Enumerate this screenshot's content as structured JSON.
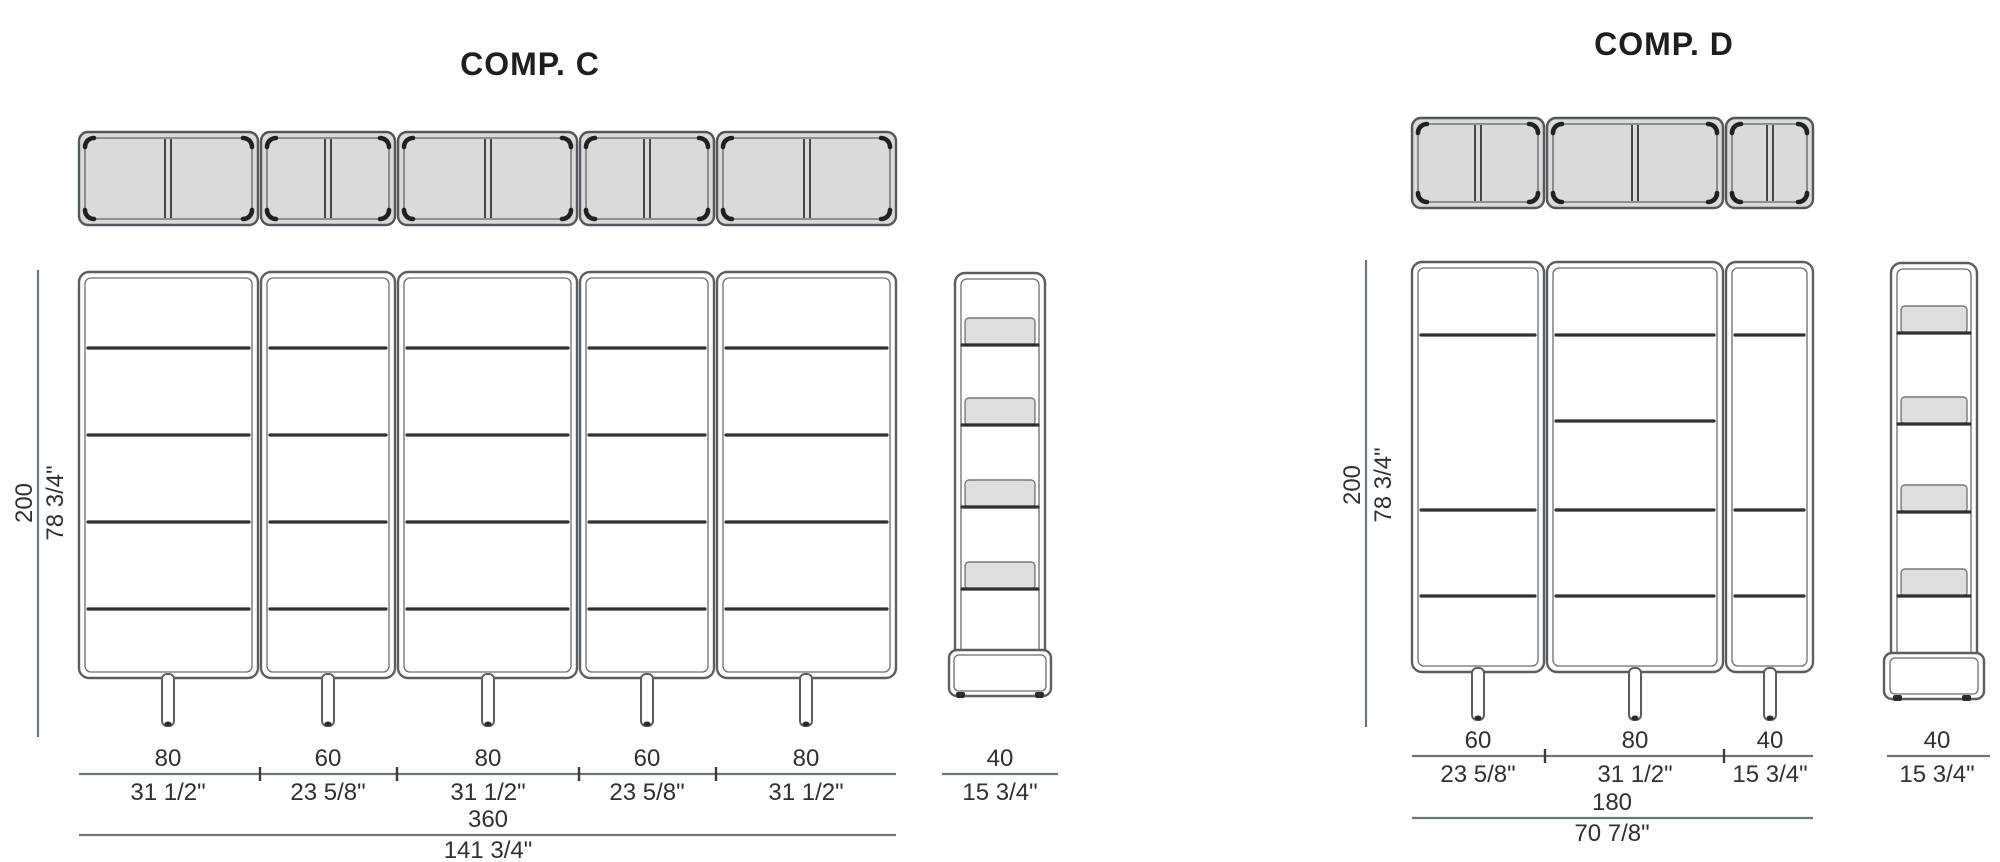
{
  "colors": {
    "background": "#ffffff",
    "frame_line": "#5b5e60",
    "shelf_line": "#2e3032",
    "panel_fill": "#d9dbda",
    "text": "#2e3032"
  },
  "comp_c": {
    "title": "COMP. C",
    "height": {
      "cm": "200",
      "in": "78 3/4\""
    },
    "segments": [
      {
        "cm": "80",
        "in": "31 1/2\""
      },
      {
        "cm": "60",
        "in": "23 5/8\""
      },
      {
        "cm": "80",
        "in": "31 1/2\""
      },
      {
        "cm": "60",
        "in": "23 5/8\""
      },
      {
        "cm": "80",
        "in": "31 1/2\""
      }
    ],
    "total": {
      "cm": "360",
      "in": "141 3/4\""
    },
    "side_depth": {
      "cm": "40",
      "in": "15 3/4\""
    }
  },
  "comp_d": {
    "title": "COMP. D",
    "height": {
      "cm": "200",
      "in": "78 3/4\""
    },
    "segments": [
      {
        "cm": "60",
        "in": "23 5/8\""
      },
      {
        "cm": "80",
        "in": "31 1/2\""
      },
      {
        "cm": "40",
        "in": "15 3/4\""
      }
    ],
    "total": {
      "cm": "180",
      "in": "70 7/8\""
    },
    "side_depth": {
      "cm": "40",
      "in": "15 3/4\""
    }
  }
}
